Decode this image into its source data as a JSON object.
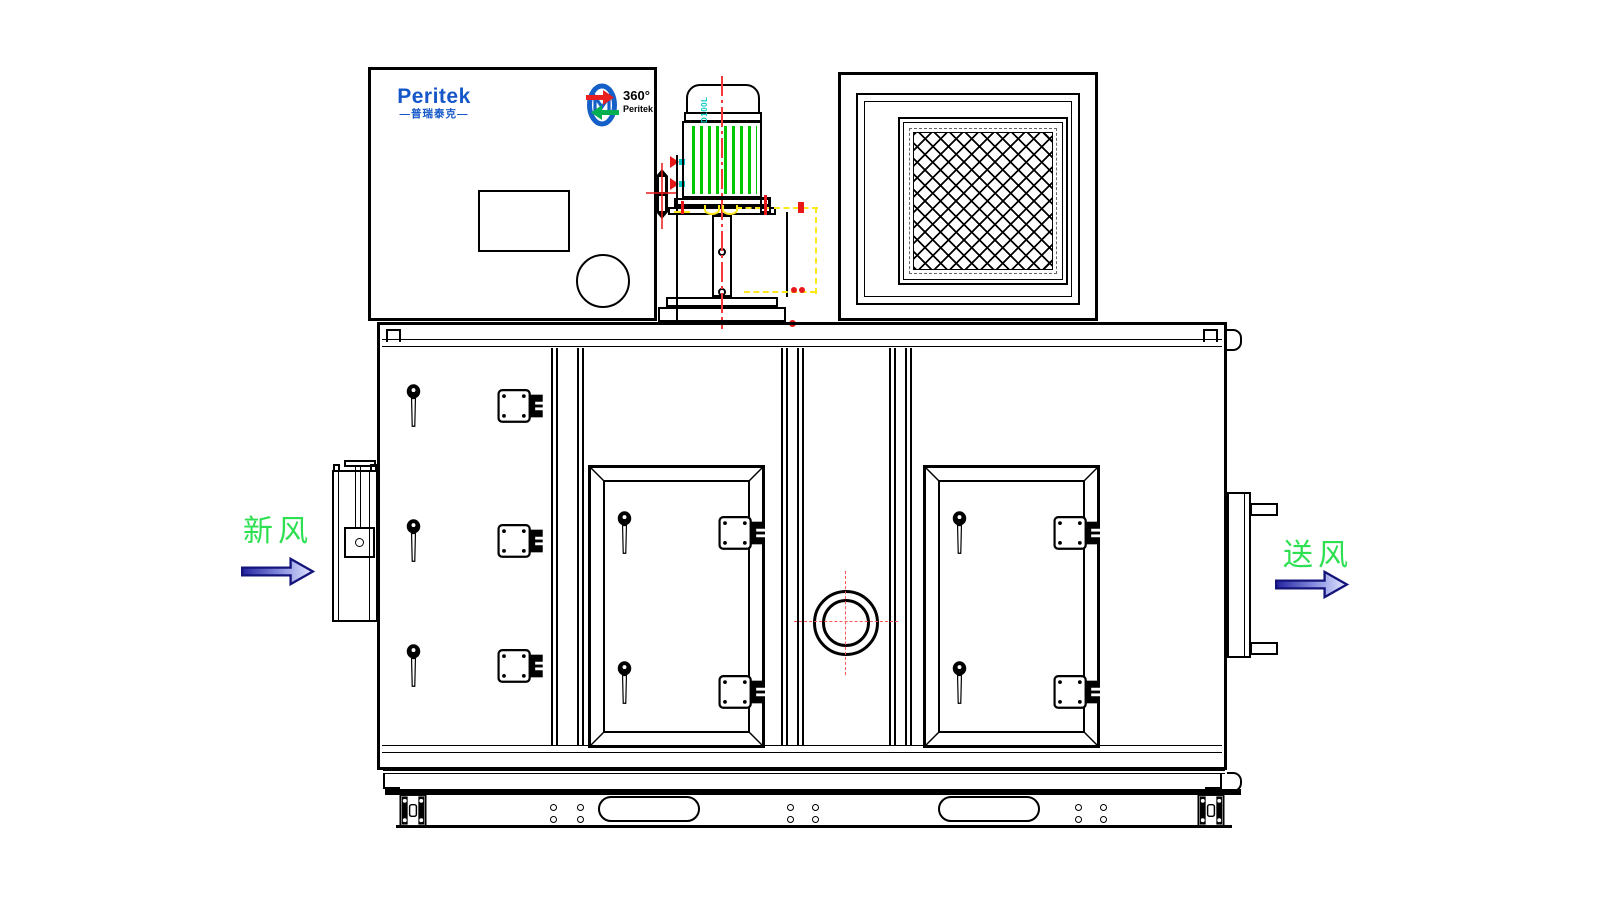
{
  "drawing": {
    "type": "equipment-front-elevation",
    "brand": {
      "name": "Peritek",
      "name_cn_banner": "—普瑞泰克—"
    },
    "logo360": {
      "degrees_label": "360°",
      "brand_label": "Peritek"
    },
    "motor": {
      "model_label": "D100L"
    },
    "flow_labels": {
      "fresh_air": "新风",
      "supply_air": "送风"
    },
    "colors": {
      "line": "#000000",
      "brand_blue": "#1557c8",
      "label_green": "#2de052",
      "fin_green": "#00c800",
      "centerline_red": "#f53838",
      "marker_red": "#e81818",
      "dash_yellow": "#ffe81a",
      "cyan": "#00c8c8",
      "arrow_outline": "#14147a",
      "arrow_dark": "#2323a0",
      "arrow_light": "#e4e8ff",
      "logo_ring_blue": "#1560c8",
      "logo_arrow_red": "#e82020",
      "logo_arrow_green": "#00b050"
    }
  }
}
